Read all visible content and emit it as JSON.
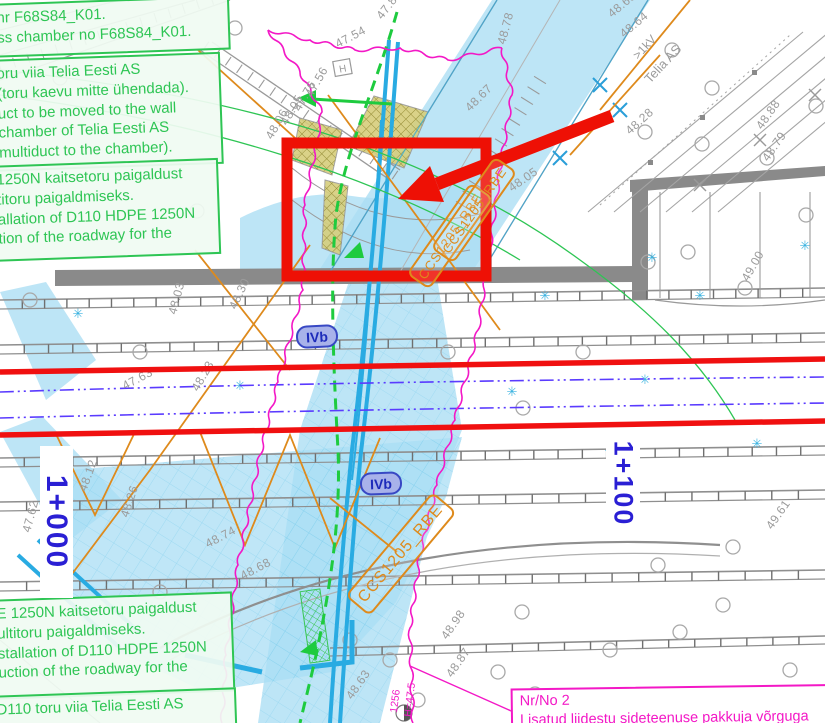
{
  "colors": {
    "highlight_blue": "#aadef4",
    "route_cyan": "#29abe2",
    "annotation_red": "#ee1005",
    "revision_magenta": "#f318c6",
    "note_green": "#2ec554",
    "duct_orange": "#de8a1c",
    "chainage_blue": "#2a1fd4",
    "axis_violet": "#5a3bff",
    "map_grey": "#9b9b9b",
    "khaki_fill": "#d6ce7c"
  },
  "notes": {
    "box1": {
      "line1": "hr F68S84_K01.",
      "line2": "ss chamber no F68S84_K01."
    },
    "box2": {
      "line1": "oru viia Telia Eesti AS",
      "line2": "(toru kaevu mitte ühendada).",
      "line3": "uct to be moved to the wall",
      "line4": "chamber of Telia Eesti AS",
      "line5": "multiduct to the chamber)."
    },
    "box3": {
      "line1": "1250N kaitsetoru paigaldust",
      "line2": "titoru paigaldmiseks.",
      "line3": "allation of D110 HDPE 1250N",
      "line4": "tion of the roadway for the"
    },
    "box4": {
      "line1": "E 1250N kaitsetoru paigaldust",
      "line2": "ultitoru paigaldmiseks.",
      "line3": "stallation of D110 HDPE 1250N",
      "line4": "uction of the roadway for the"
    },
    "box5": {
      "line1": "D110 toru viia Telia Eesti AS"
    }
  },
  "revision_note": {
    "number": "Nr/No 2",
    "text": "Lisatud liidestu sideteenuse pakkuja võrguga"
  },
  "duct_labels": {
    "label1": "CCS1205_RBE",
    "label2": "CCS1205_RBE",
    "label3": "CCS1205_RBE"
  },
  "chainage": {
    "station1": "1+000",
    "station2": "1+100"
  },
  "road_class": {
    "label1": "IVb",
    "label2": "IVb"
  },
  "survey_point": {
    "id": "1256",
    "height": "H=47.5"
  },
  "utility_labels": {
    "telia": "Telia AS",
    "power": ">1kV",
    "hydrant": "H"
  },
  "elevations": [
    {
      "t": "47.87",
      "x": 382,
      "y": 20,
      "a": -52
    },
    {
      "t": "48.65",
      "x": 612,
      "y": 18,
      "a": -40
    },
    {
      "t": "48.64",
      "x": 624,
      "y": 38,
      "a": -40
    },
    {
      "t": "48.78",
      "x": 505,
      "y": 45,
      "a": -75
    },
    {
      "t": "48.67",
      "x": 470,
      "y": 112,
      "a": -45
    },
    {
      "t": "48.88",
      "x": 762,
      "y": 130,
      "a": -55
    },
    {
      "t": "48.79",
      "x": 768,
      "y": 162,
      "a": -55
    },
    {
      "t": "48.28",
      "x": 630,
      "y": 135,
      "a": -42
    },
    {
      "t": "48.05",
      "x": 512,
      "y": 192,
      "a": -35
    },
    {
      "t": "47.54",
      "x": 338,
      "y": 48,
      "a": -28
    },
    {
      "t": "47.56",
      "x": 312,
      "y": 98,
      "a": -60
    },
    {
      "t": "47.76",
      "x": 300,
      "y": 112,
      "a": -60
    },
    {
      "t": "48.05",
      "x": 287,
      "y": 126,
      "a": -60
    },
    {
      "t": "48.06",
      "x": 272,
      "y": 140,
      "a": -60
    },
    {
      "t": "48.30",
      "x": 236,
      "y": 310,
      "a": -65
    },
    {
      "t": "48.03",
      "x": 176,
      "y": 315,
      "a": -75
    },
    {
      "t": "47.63",
      "x": 125,
      "y": 390,
      "a": -28
    },
    {
      "t": "48.23",
      "x": 198,
      "y": 392,
      "a": -60
    },
    {
      "t": "48.12",
      "x": 86,
      "y": 492,
      "a": -70
    },
    {
      "t": "47.62",
      "x": 30,
      "y": 533,
      "a": -75
    },
    {
      "t": "48.26",
      "x": 128,
      "y": 518,
      "a": -72
    },
    {
      "t": "48.74",
      "x": 208,
      "y": 548,
      "a": -28
    },
    {
      "t": "48.68",
      "x": 243,
      "y": 580,
      "a": -28
    },
    {
      "t": "48.63",
      "x": 352,
      "y": 700,
      "a": -55
    },
    {
      "t": "48.98",
      "x": 447,
      "y": 640,
      "a": -55
    },
    {
      "t": "48.87",
      "x": 452,
      "y": 678,
      "a": -55
    },
    {
      "t": "49.00",
      "x": 748,
      "y": 282,
      "a": -60
    },
    {
      "t": "49.61",
      "x": 772,
      "y": 530,
      "a": -55
    }
  ],
  "map_symbols": {
    "star_glyph": "✳",
    "star_positions": [
      [
        78,
        318
      ],
      [
        240,
        390
      ],
      [
        512,
        396
      ],
      [
        645,
        384
      ],
      [
        700,
        300
      ],
      [
        805,
        250
      ],
      [
        757,
        448
      ],
      [
        652,
        262
      ],
      [
        545,
        300
      ],
      [
        610,
        455
      ]
    ],
    "circle_positions": [
      [
        60,
        78
      ],
      [
        235,
        28
      ],
      [
        296,
        148
      ],
      [
        197,
        211
      ],
      [
        140,
        352
      ],
      [
        30,
        300
      ],
      [
        448,
        352
      ],
      [
        523,
        408
      ],
      [
        583,
        352
      ],
      [
        672,
        50
      ],
      [
        712,
        88
      ],
      [
        645,
        132
      ],
      [
        702,
        144
      ],
      [
        816,
        106
      ],
      [
        767,
        158
      ],
      [
        648,
        262
      ],
      [
        688,
        252
      ],
      [
        806,
        215
      ],
      [
        745,
        288
      ],
      [
        733,
        547
      ],
      [
        723,
        605
      ],
      [
        790,
        670
      ],
      [
        390,
        660
      ],
      [
        418,
        700
      ],
      [
        498,
        672
      ],
      [
        522,
        612
      ],
      [
        610,
        650
      ],
      [
        680,
        632
      ],
      [
        350,
        640
      ],
      [
        160,
        592
      ],
      [
        55,
        585
      ],
      [
        625,
        520
      ],
      [
        658,
        565
      ],
      [
        535,
        694
      ]
    ]
  }
}
